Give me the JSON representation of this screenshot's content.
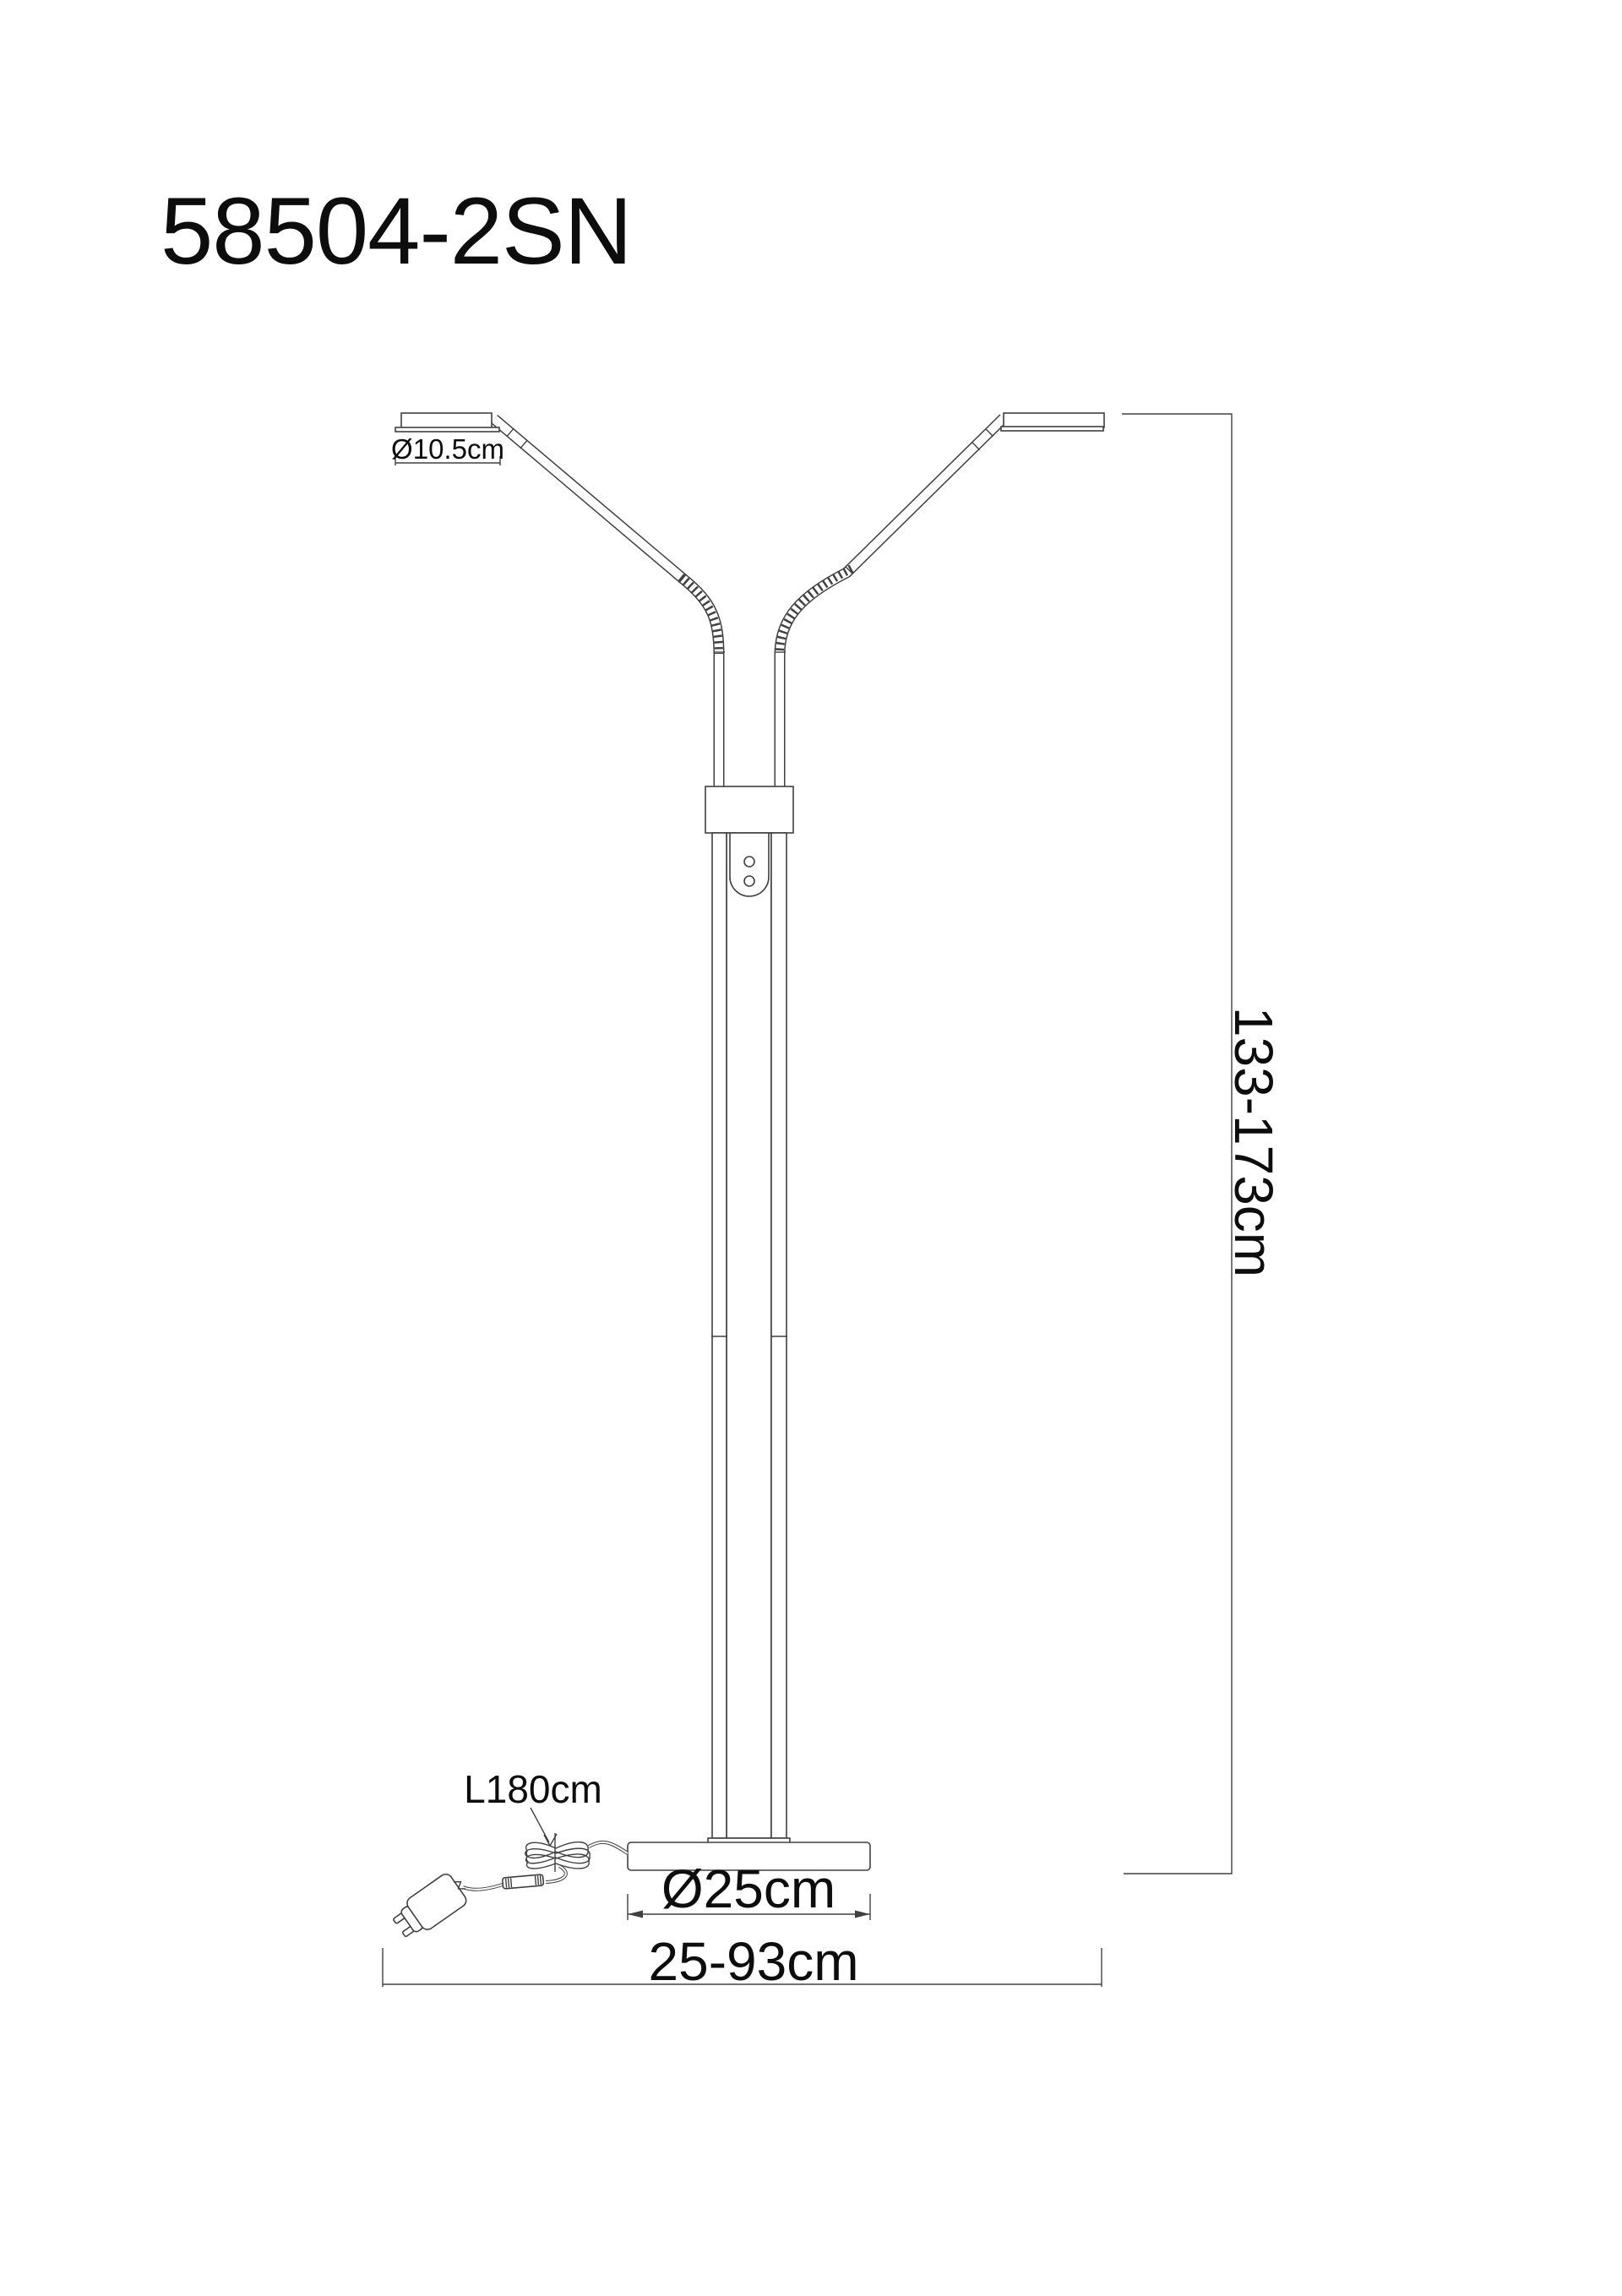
{
  "title": "58504-2SN",
  "labels": {
    "head_diameter": "Ø10.5cm",
    "cord_length": "L180cm",
    "base_diameter": "Ø25cm",
    "width_range": "25-93cm",
    "height_range": "133-173cm"
  },
  "colors": {
    "line": "#404040",
    "text": "#0d0d0d",
    "background": "#ffffff"
  }
}
